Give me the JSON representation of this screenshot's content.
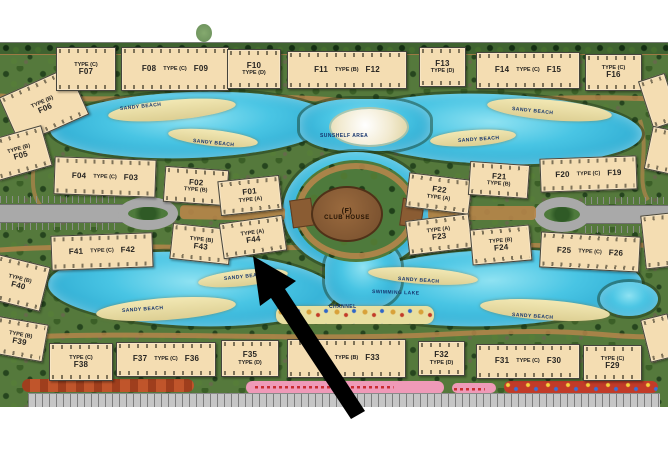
{
  "map": {
    "colors": {
      "water": "#49c5e4",
      "land": "#55793c",
      "beach": "#e8dfa0",
      "building_fill": "#f4ddb2",
      "road": "#a9a9a9",
      "path": "#b5854a",
      "clubhouse": "#7c5330",
      "arrow": "#000000",
      "track_orange": "#c0552b",
      "strip_pink": "#ef9ab8",
      "strip_red": "#c23b28"
    },
    "clubhouse": {
      "line1": "(F)",
      "line2": "CLUB HOUSE"
    },
    "buildings": [
      {
        "id": "F06",
        "x": 6,
        "y": 80,
        "w": 74,
        "h": 50,
        "rot": -24,
        "lines": [
          "TYPE (B)",
          "F06"
        ]
      },
      {
        "id": "F07",
        "x": 56,
        "y": 47,
        "w": 58,
        "h": 42,
        "rot": 0,
        "lines": [
          "TYPE (C)",
          "F07"
        ]
      },
      {
        "id": "F08-F09",
        "x": 121,
        "y": 47,
        "w": 106,
        "h": 42,
        "rot": 0,
        "row": [
          "F08",
          "TYPE (C)",
          "F09"
        ]
      },
      {
        "id": "F10",
        "x": 227,
        "y": 49,
        "w": 52,
        "h": 38,
        "rot": 0,
        "lines": [
          "F10",
          "TYPE (D)"
        ]
      },
      {
        "id": "F11-F12",
        "x": 287,
        "y": 51,
        "w": 118,
        "h": 36,
        "rot": 0,
        "row": [
          "F11",
          "TYPE (B)",
          "F12"
        ]
      },
      {
        "id": "F13",
        "x": 419,
        "y": 47,
        "w": 45,
        "h": 38,
        "rot": 0,
        "lines": [
          "F13",
          "TYPE (D)"
        ]
      },
      {
        "id": "F14-F15",
        "x": 476,
        "y": 52,
        "w": 102,
        "h": 35,
        "rot": 0,
        "row": [
          "F14",
          "TYPE (C)",
          "F15"
        ]
      },
      {
        "id": "F16",
        "x": 585,
        "y": 54,
        "w": 55,
        "h": 35,
        "rot": 0,
        "lines": [
          "TYPE (C)",
          "F16"
        ]
      },
      {
        "id": "F05",
        "x": -8,
        "y": 132,
        "w": 54,
        "h": 40,
        "rot": -16,
        "lines": [
          "TYPE (B)",
          "F05"
        ]
      },
      {
        "id": "F04-F03",
        "x": 54,
        "y": 158,
        "w": 100,
        "h": 36,
        "rot": 2,
        "row": [
          "F04",
          "TYPE (C)",
          "F03"
        ]
      },
      {
        "id": "F02",
        "x": 164,
        "y": 168,
        "w": 62,
        "h": 34,
        "rot": 4,
        "lines": [
          "F02",
          "TYPE (B)"
        ]
      },
      {
        "id": "F01",
        "x": 219,
        "y": 178,
        "w": 60,
        "h": 33,
        "rot": -6,
        "lines": [
          "F01",
          "TYPE (A)"
        ]
      },
      {
        "id": "F43",
        "x": 171,
        "y": 226,
        "w": 58,
        "h": 34,
        "rot": 6,
        "lines": [
          "TYPE (B)",
          "F43"
        ]
      },
      {
        "id": "F44",
        "x": 221,
        "y": 219,
        "w": 62,
        "h": 34,
        "rot": -8,
        "lines": [
          "TYPE (A)",
          "F44"
        ]
      },
      {
        "id": "F22",
        "x": 407,
        "y": 176,
        "w": 62,
        "h": 33,
        "rot": 7,
        "lines": [
          "F22",
          "TYPE (A)"
        ]
      },
      {
        "id": "F21",
        "x": 469,
        "y": 163,
        "w": 58,
        "h": 32,
        "rot": 4,
        "lines": [
          "F21",
          "TYPE (B)"
        ]
      },
      {
        "id": "F23",
        "x": 407,
        "y": 217,
        "w": 62,
        "h": 33,
        "rot": -7,
        "lines": [
          "TYPE (A)",
          "F23"
        ]
      },
      {
        "id": "F24",
        "x": 471,
        "y": 227,
        "w": 58,
        "h": 34,
        "rot": -5,
        "lines": [
          "TYPE (B)",
          "F24"
        ]
      },
      {
        "id": "F20-F19",
        "x": 540,
        "y": 157,
        "w": 95,
        "h": 32,
        "rot": -2,
        "row": [
          "F20",
          "TYPE (C)",
          "F19"
        ]
      },
      {
        "id": "F25-F26",
        "x": 540,
        "y": 234,
        "w": 98,
        "h": 34,
        "rot": 3,
        "row": [
          "F25",
          "TYPE (C)",
          "F26"
        ]
      },
      {
        "id": "F41-F42",
        "x": 51,
        "y": 234,
        "w": 100,
        "h": 33,
        "rot": -2,
        "row": [
          "F41",
          "TYPE (C)",
          "F42"
        ]
      },
      {
        "id": "F40",
        "x": -8,
        "y": 260,
        "w": 52,
        "h": 44,
        "rot": 14,
        "lines": [
          "TYPE (B)",
          "F40"
        ]
      },
      {
        "id": "F39",
        "x": -6,
        "y": 320,
        "w": 50,
        "h": 36,
        "rot": 10,
        "lines": [
          "TYPE (B)",
          "F39"
        ]
      },
      {
        "id": "F38",
        "x": 49,
        "y": 343,
        "w": 62,
        "h": 36,
        "rot": 0,
        "lines": [
          "TYPE (C)",
          "F38"
        ]
      },
      {
        "id": "F37-F36",
        "x": 116,
        "y": 342,
        "w": 98,
        "h": 33,
        "rot": 0,
        "row": [
          "F37",
          "TYPE (C)",
          "F36"
        ]
      },
      {
        "id": "F35",
        "x": 221,
        "y": 340,
        "w": 56,
        "h": 35,
        "rot": 0,
        "lines": [
          "F35",
          "TYPE (D)"
        ]
      },
      {
        "id": "F34-F33",
        "x": 287,
        "y": 339,
        "w": 117,
        "h": 37,
        "rot": 0,
        "row": [
          "F34",
          "TYPE (B)",
          "F33"
        ]
      },
      {
        "id": "F32",
        "x": 418,
        "y": 341,
        "w": 45,
        "h": 33,
        "rot": 0,
        "lines": [
          "F32",
          "TYPE (D)"
        ]
      },
      {
        "id": "F31-F30",
        "x": 476,
        "y": 344,
        "w": 102,
        "h": 33,
        "rot": 0,
        "row": [
          "F31",
          "TYPE (C)",
          "F30"
        ]
      },
      {
        "id": "F29",
        "x": 583,
        "y": 345,
        "w": 57,
        "h": 34,
        "rot": 0,
        "lines": [
          "TYPE (C)",
          "F29"
        ]
      },
      {
        "id": "edge-1",
        "x": 645,
        "y": 76,
        "w": 26,
        "h": 48,
        "rot": -18,
        "lines": []
      },
      {
        "id": "edge-2",
        "x": 648,
        "y": 128,
        "w": 24,
        "h": 42,
        "rot": 12,
        "lines": []
      },
      {
        "id": "edge-3",
        "x": 643,
        "y": 214,
        "w": 28,
        "h": 52,
        "rot": -6,
        "lines": []
      },
      {
        "id": "edge-4",
        "x": 645,
        "y": 316,
        "w": 26,
        "h": 42,
        "rot": -14,
        "lines": []
      }
    ],
    "lake_labels": [
      {
        "t": "SANDY BEACH",
        "x": 120,
        "y": 106,
        "rot": -6
      },
      {
        "t": "SANDY BEACH",
        "x": 193,
        "y": 138,
        "rot": 6
      },
      {
        "t": "SANDY BEACH",
        "x": 512,
        "y": 106,
        "rot": 6
      },
      {
        "t": "SANDY BEACH",
        "x": 458,
        "y": 138,
        "rot": -4
      },
      {
        "t": "SUNSHELF AREA",
        "x": 320,
        "y": 133,
        "rot": 0
      },
      {
        "t": "SANDY BEACH",
        "x": 122,
        "y": 308,
        "rot": -4
      },
      {
        "t": "SANDY BEACH",
        "x": 224,
        "y": 276,
        "rot": -6
      },
      {
        "t": "SANDY BEACH",
        "x": 398,
        "y": 276,
        "rot": 4
      },
      {
        "t": "SWIMMING LAKE",
        "x": 372,
        "y": 289,
        "rot": 2
      },
      {
        "t": "CHANNEL",
        "x": 329,
        "y": 304,
        "rot": 0
      },
      {
        "t": "SANDY BEACH",
        "x": 512,
        "y": 312,
        "rot": 4
      }
    ]
  }
}
